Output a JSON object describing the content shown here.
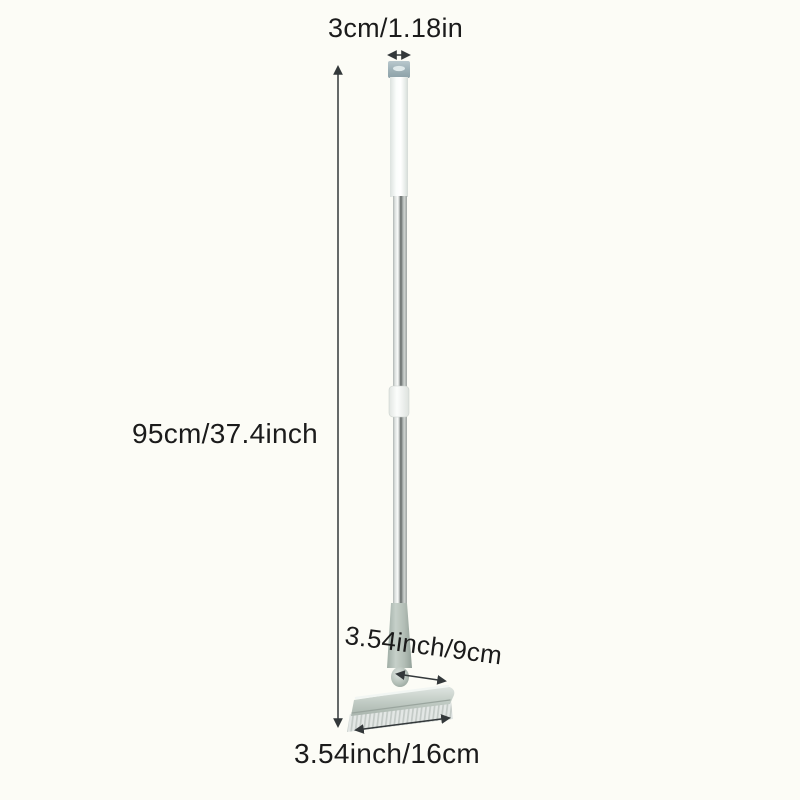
{
  "page": {
    "background_color": "#fcfcf6",
    "text_color": "#1b1b1b",
    "annotation_color": "#33383a"
  },
  "dimension_labels": {
    "handle_width": "3cm/1.18in",
    "total_length": "95cm/37.4inch",
    "head_depth": "3.54inch/9cm",
    "head_width": "3.54inch/16cm"
  },
  "product_colors": {
    "hanger_cap": "#9db0b7",
    "grip": "#f4f7f5",
    "pole_chrome_dark_stripe": "#5d6261",
    "connector_collar": "#f0f3f0",
    "neck_plastic": "#b2bdb5",
    "head_plastic": "#b7c2ba",
    "bristles": "#d9dedb"
  }
}
